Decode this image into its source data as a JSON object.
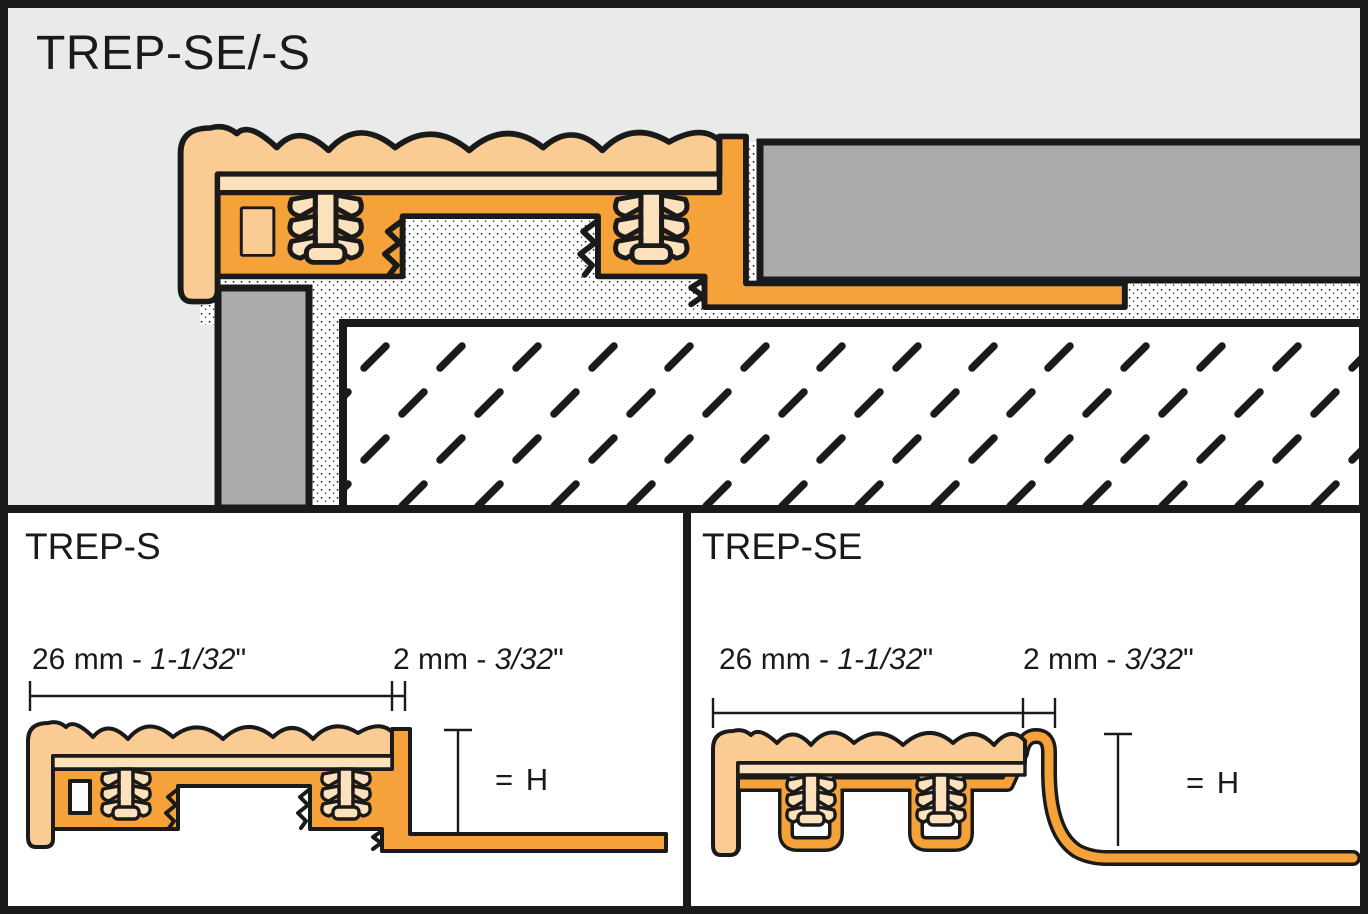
{
  "header": {
    "title": "TREP-SE/-S"
  },
  "panel_trep_s": {
    "title": "TREP-S",
    "dim_width_metric": "26 mm - ",
    "dim_width_imperial": "1-1/32",
    "dim_width_quote": "\"",
    "dim_edge_metric": "2 mm - ",
    "dim_edge_imperial": "3/32",
    "dim_edge_quote": "\"",
    "height_label": "= H"
  },
  "panel_trep_se": {
    "title": "TREP-SE",
    "dim_width_metric": "26 mm - ",
    "dim_width_imperial": "1-1/32",
    "dim_width_quote": "\"",
    "dim_edge_metric": "2 mm - ",
    "dim_edge_imperial": "3/32",
    "dim_edge_quote": "\"",
    "height_label": "= H"
  },
  "colors": {
    "profile_orange": "#F5A23B",
    "insert_tan": "#FACB92",
    "insert_pale": "#FCE2BC",
    "tile_gray": "#A9ABAD",
    "background_gray": "#E9EBEB",
    "line_black": "#1A1A1A",
    "mortar_white": "#FFFFFF"
  }
}
